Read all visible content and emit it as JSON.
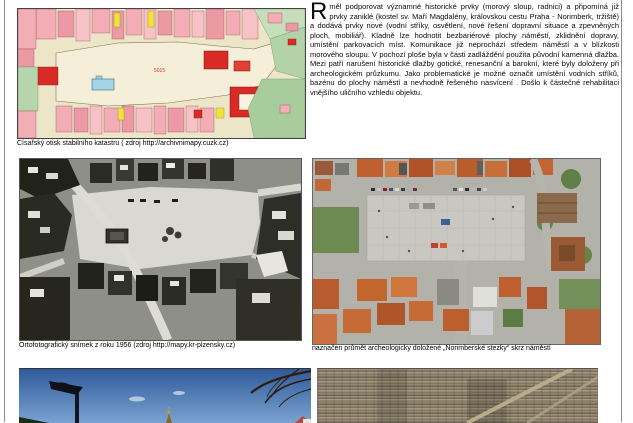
{
  "document": {
    "frame_color": "#8c8c8c",
    "language": "cs"
  },
  "article": {
    "drop_cap": "R",
    "body": "měl podporovat významné historické prvky (morový sloup, radnici) a připomíná již prvky zaniklé (kostel sv. Maří Magdalény, královskou cestu Praha -  Norimberk, tržiště) a dodává prvky nové (vodní stříky, osvětlení, nové řešení dopravní situace a zpevněných ploch, mobiliář). Kladně lze hodnotit bezbariérové plochy náměstí, zklidnění dopravy, umístění parkovacích míst. Komunikace již neprochází středem náměstí a v blízkosti morového sloupu. V pochozí ploše byla v části zadláždění použita původní kamenná dlažba. Mezi patří narušení historické dlažby gotické, renesanční a barokní, které byly doloženy při archeologickém průzkumu. Jako problematické je možné označit umístění vodních stříků, bazénu do plochy náměstí a nevhodně řešeného nasvícení . Došlo k částečné rehabilitaci vnějšího uličního vzhledu objektu."
  },
  "figures": {
    "cadastral_map": {
      "caption": "Císařský otisk stabilního katastru ( zdroj http://archivnimapy.cuzk.cz)",
      "plaza_label": "5015",
      "alt": "historic cadastral map with pink buildings, red church, green gardens, blue pond and central square"
    },
    "orthophoto_1956": {
      "caption": "Ortofotografický snímek z roku 1956 (zdroj http://mapy.kr-plzensky.cz)",
      "alt": "black-and-white aerial orthophoto of the town square"
    },
    "aerial_current": {
      "caption": "naznačen průmět archeologicky doložené „Norimberské stezky“ skrz náměstí",
      "alt": "current color aerial photo of the paved town square with orange roofs"
    },
    "street_lamp_photo": {
      "alt": "blue sky with street lamp, bare branches and golden spire tip"
    },
    "pavement_photo": {
      "alt": "detail of striped cobblestone paving of the square"
    }
  },
  "colors": {
    "map_pink": "#f2aeb4",
    "map_red": "#d92b26",
    "map_green": "#b3d2a8",
    "map_yellow": "#f1e13c",
    "map_blue_pond": "#a5d4e6",
    "sky_top": "#2f5a9a",
    "sky_bottom": "#7aa3d1"
  }
}
